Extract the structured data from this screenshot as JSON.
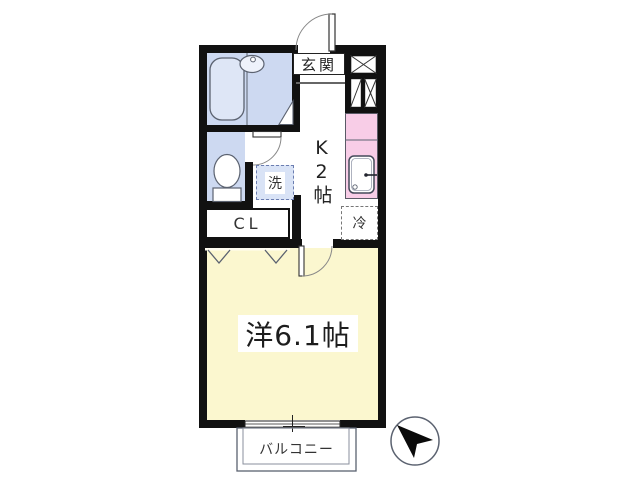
{
  "labels": {
    "entrance": "玄関",
    "kitchen": "K2帖",
    "washing_machine": "洗",
    "refrigerator": "冷",
    "closet": "CL",
    "western_room": "洋6.1帖",
    "balcony": "バルコニー"
  },
  "colors": {
    "wall": "#111111",
    "wet_area_floor": "#cdd9f1",
    "kitchen_counter": "#f8cde7",
    "room_floor": "#fbf7cf",
    "washer_pad": "#d9e3f6"
  }
}
